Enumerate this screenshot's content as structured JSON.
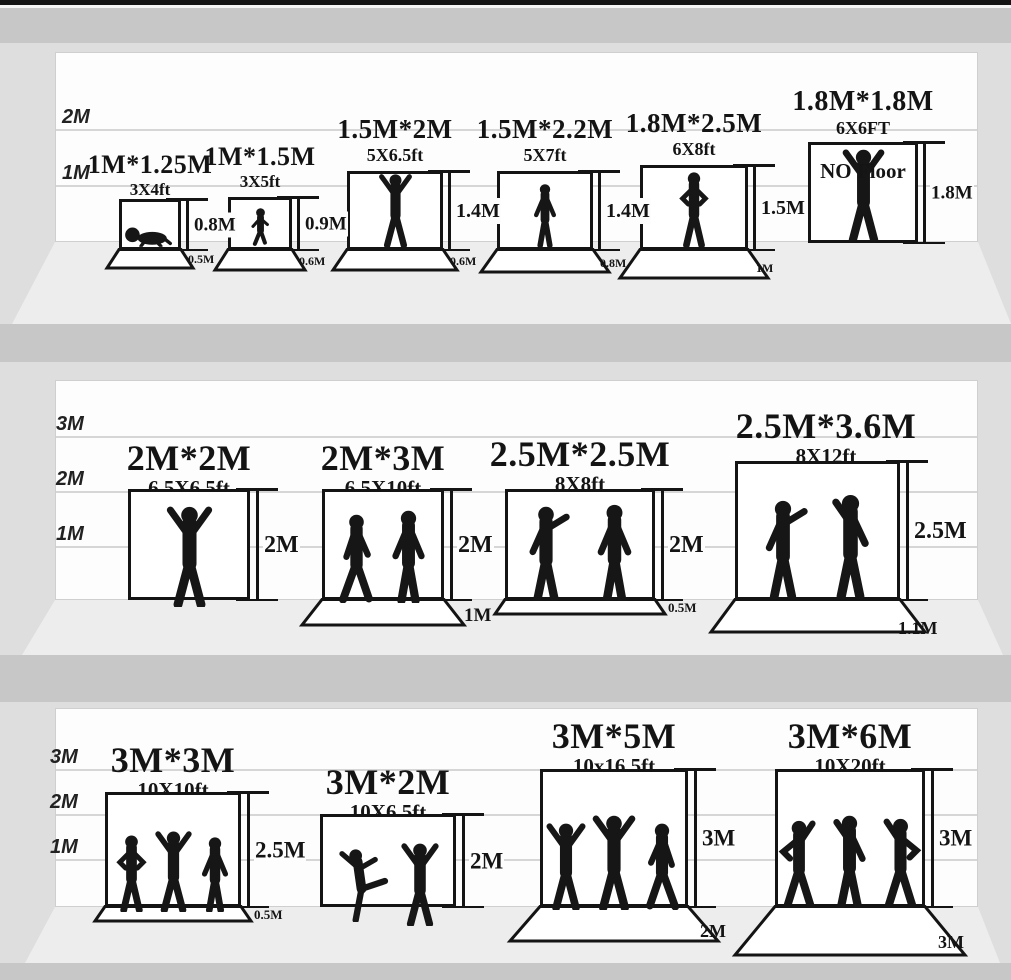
{
  "meta": {
    "title": "Photography backdrop size comparison chart",
    "colors": {
      "frame_black": "#141414",
      "wall_white": "#fdfdfd",
      "side_gray": "#dedede",
      "divider_gray": "#c7c7c7",
      "floor_gray": "#ededed",
      "gridline_gray": "#d6d6d6"
    }
  },
  "rows": [
    {
      "scale_labels": [
        "2M",
        "1M"
      ],
      "items": [
        {
          "title": "1M*1.25M",
          "subtitle": "3X4ft",
          "height_label": "0.8M",
          "floor_label": "0.5M",
          "figure": "crawling-baby"
        },
        {
          "title": "1M*1.5M",
          "subtitle": "3X5ft",
          "height_label": "0.9M",
          "floor_label": "0.6M",
          "figure": "sitting-toddler"
        },
        {
          "title": "1.5M*2M",
          "subtitle": "5X6.5ft",
          "height_label": "1.4M",
          "floor_label": "0.6M",
          "figure": "woman-arms-raised"
        },
        {
          "title": "1.5M*2.2M",
          "subtitle": "5X7ft",
          "height_label": "1.4M",
          "floor_label": "0.8M",
          "figure": "boy-standing"
        },
        {
          "title": "1.8M*2.5M",
          "subtitle": "6X8ft",
          "height_label": "1.5M",
          "floor_label": "1M",
          "figure": "man-hands-on-hips"
        },
        {
          "title": "1.8M*1.8M",
          "subtitle": "6X6FT",
          "note": "NO Floor",
          "height_label": "1.8M",
          "figure": "man-arms-raised"
        }
      ]
    },
    {
      "scale_labels": [
        "3M",
        "2M",
        "1M"
      ],
      "items": [
        {
          "title": "2M*2M",
          "subtitle": "6.5X6.5ft",
          "height_label": "2M",
          "figure": "man-arms-raised"
        },
        {
          "title": "2M*3M",
          "subtitle": "6.5X10ft",
          "height_label": "2M",
          "floor_label": "1M",
          "figure": "two-men-walking"
        },
        {
          "title": "2.5M*2.5M",
          "subtitle": "8X8ft",
          "height_label": "2M",
          "floor_label": "0.5M",
          "figure": "two-men-talking"
        },
        {
          "title": "2.5M*3.6M",
          "subtitle": "8X12ft",
          "height_label": "2.5M",
          "floor_label": "1.1M",
          "figure": "man-pointing-and-man"
        }
      ]
    },
    {
      "scale_labels": [
        "3M",
        "2M",
        "1M"
      ],
      "items": [
        {
          "title": "3M*3M",
          "subtitle": "10X10ft",
          "height_label": "2.5M",
          "floor_label": "0.5M",
          "figure": "three-people-standing"
        },
        {
          "title": "3M*2M",
          "subtitle": "10X6.5ft",
          "height_label": "2M",
          "figure": "two-people-dancing"
        },
        {
          "title": "3M*5M",
          "subtitle": "10x16.5ft",
          "height_label": "3M",
          "floor_label": "2M",
          "figure": "three-people-dancing"
        },
        {
          "title": "3M*6M",
          "subtitle": "10X20ft",
          "height_label": "3M",
          "floor_label": "3M",
          "figure": "three-person-band"
        }
      ]
    }
  ]
}
